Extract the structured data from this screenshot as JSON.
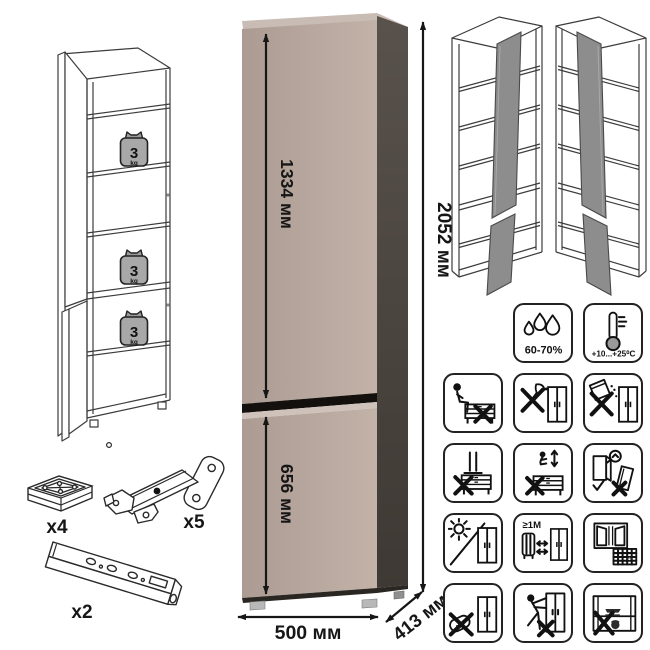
{
  "diagram": {
    "dimensions": {
      "upper_door_height": "1334 мм",
      "lower_door_height": "656 мм",
      "total_height": "2052 мм",
      "width": "500 мм",
      "depth": "413 мм"
    },
    "shelf_load": {
      "value": "3",
      "unit": "kg"
    },
    "hardware": {
      "foot_qty": "x4",
      "hinge_qty": "x5",
      "rail_qty": "x2"
    },
    "environment": {
      "humidity_range": "60-70%",
      "temperature_range": "+10...+25⁰C"
    },
    "care": {
      "heater_distance": "≥1M",
      "ventilation_days": "21"
    },
    "icon_names": [
      "humidity-icon",
      "temperature-icon",
      "no-sitting-icon",
      "no-sharp-tools-icon",
      "no-abrasives-icon",
      "no-standing-icon",
      "no-jumping-icon",
      "anchor-to-wall-icon",
      "no-direct-sunlight-icon",
      "heater-distance-icon",
      "ventilation-icon",
      "no-wet-cleaning-icon",
      "no-dragging-icon",
      "no-overloading-icon"
    ],
    "colors": {
      "front": "#b3a29a",
      "front_light": "#cfc2ba",
      "top": "#c9bcb4",
      "side": "#4a443f",
      "divider": "#14100d",
      "door_open_gray": "#8d8d8d"
    }
  }
}
